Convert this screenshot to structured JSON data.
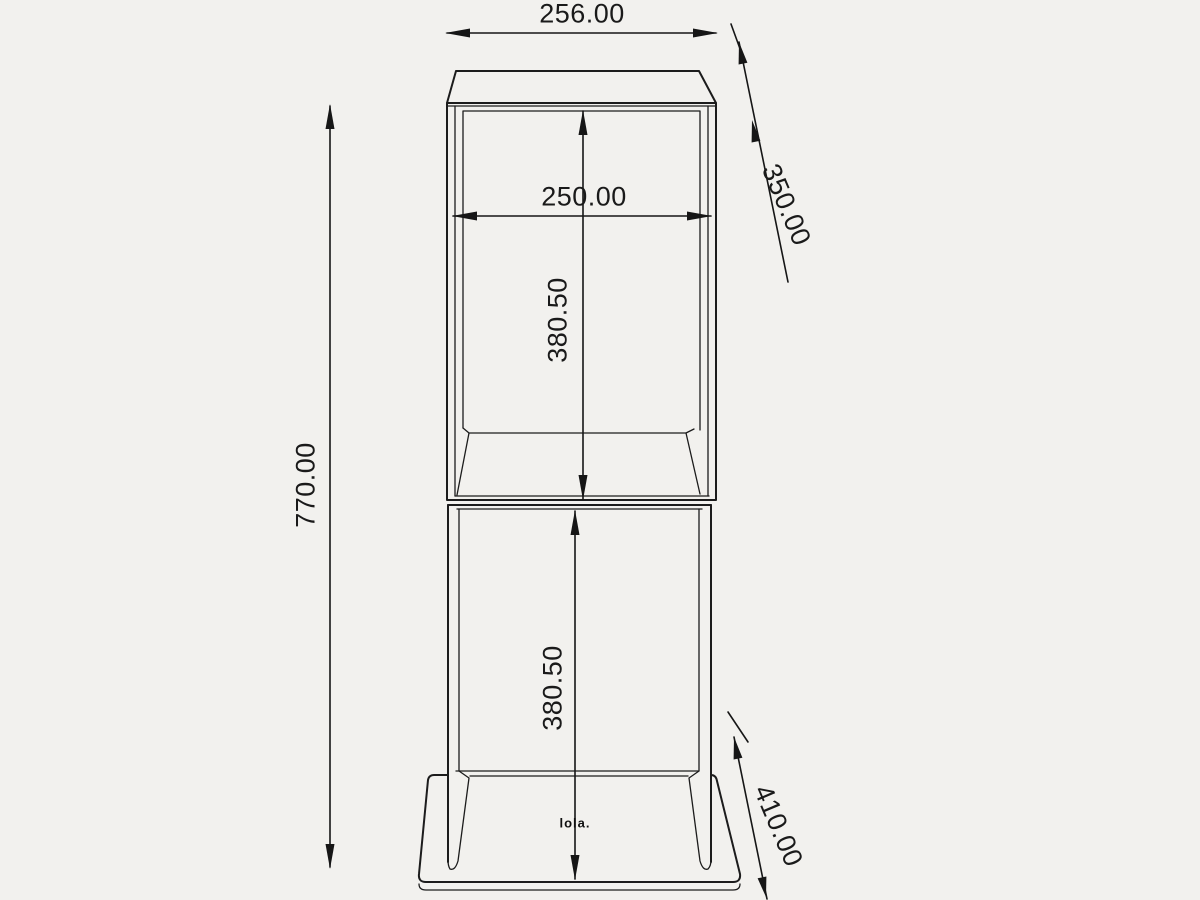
{
  "drawing": {
    "type": "technical-dimension-drawing",
    "object": "two-tier floor stand with base plate",
    "logo": "lola.",
    "colors": {
      "background": "#f2f1ee",
      "line": "#1c1c1c",
      "text": "#1a1a1a"
    },
    "dimensions": {
      "top_width": "256.00",
      "top_depth": "350.00",
      "inner_width": "250.00",
      "upper_compartment_height": "380.50",
      "overall_height": "770.00",
      "lower_compartment_height": "380.50",
      "base_depth": "410.00"
    }
  }
}
